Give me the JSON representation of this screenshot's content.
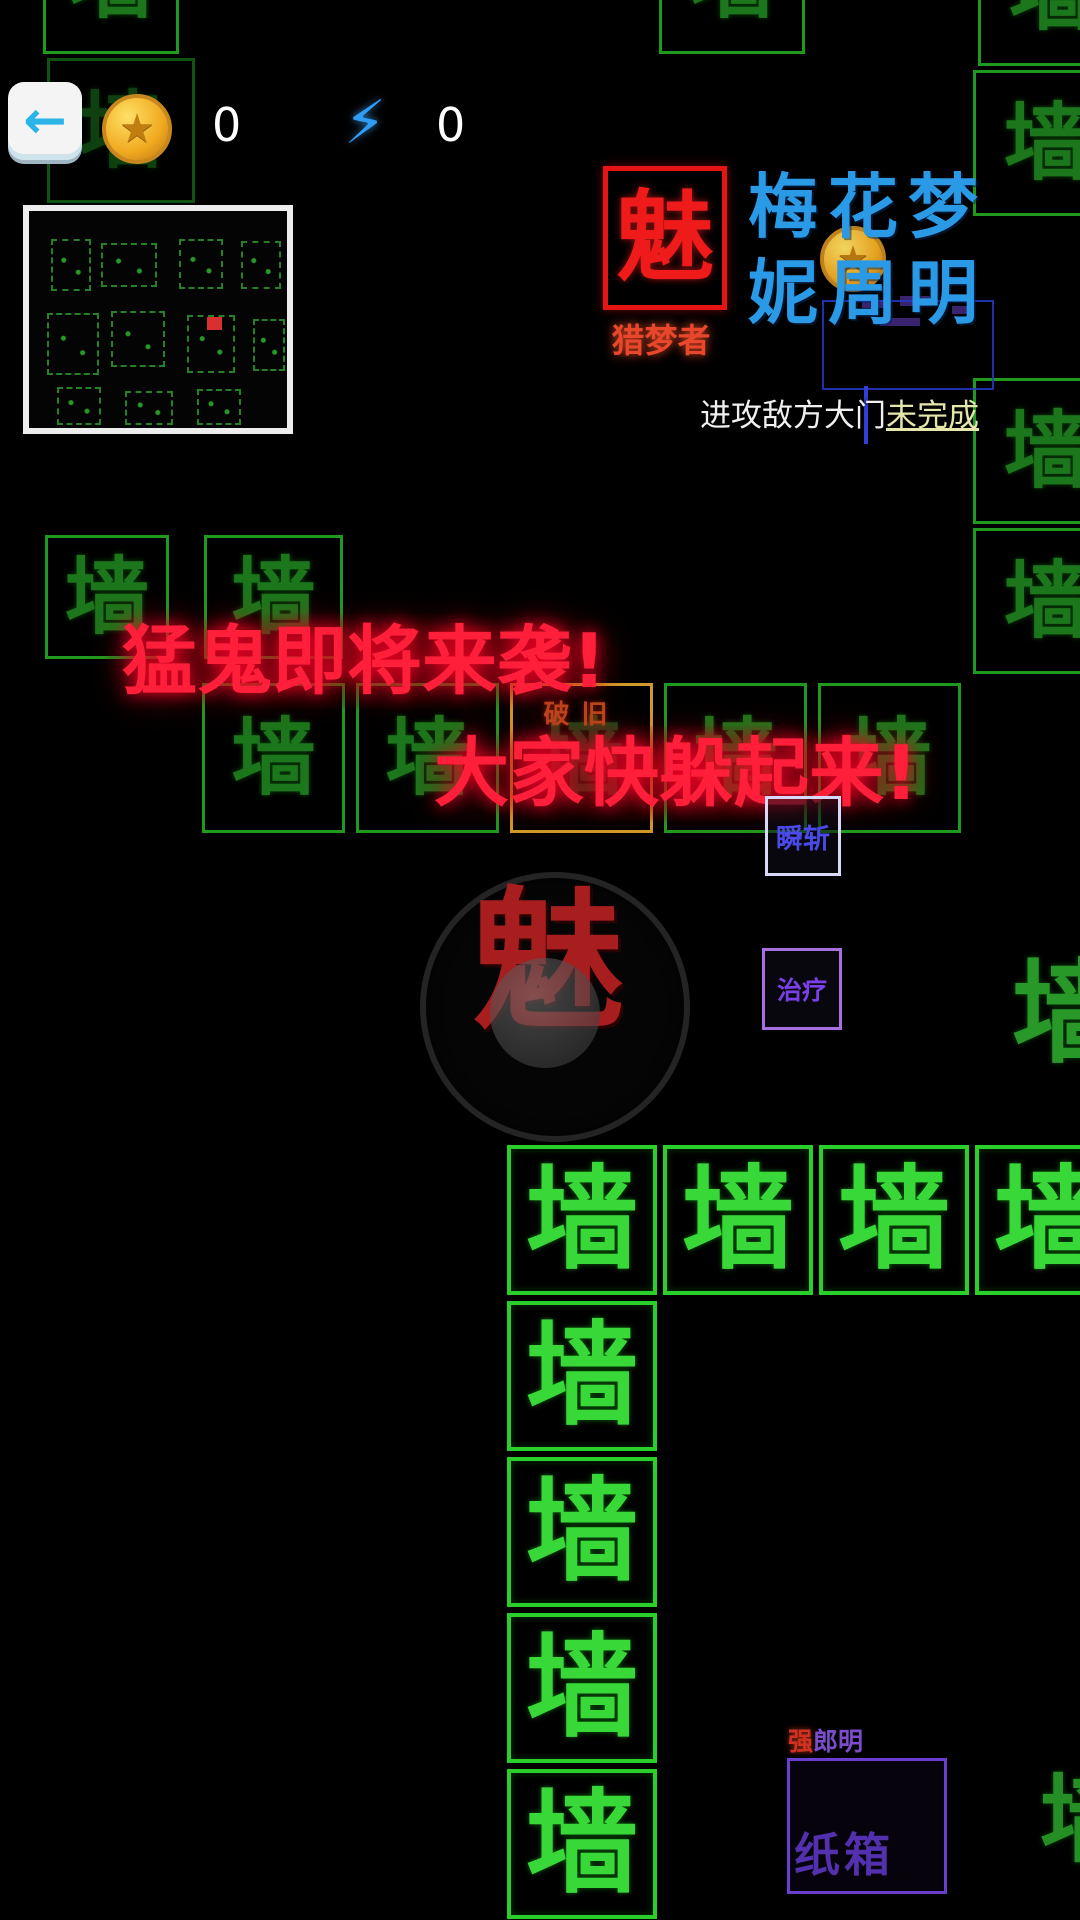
{
  "hud": {
    "back_icon": "←",
    "coin_star": "★",
    "coin_count": "0",
    "bolt_icon": "⚡",
    "energy_count": "0"
  },
  "logo": {
    "glyph": "魅",
    "subtitle": "猎梦者"
  },
  "player": {
    "name_line1": "梅花梦",
    "name_line2": "妮周明"
  },
  "quest": {
    "text": "进攻敌方大门",
    "status": "未完成"
  },
  "warnings": {
    "line1": "猛鬼即将来袭!",
    "line2": "大家快躲起来!"
  },
  "tiles": {
    "wall_glyph": "墙",
    "worn_label": "破旧"
  },
  "character": {
    "glyph": "魅"
  },
  "skills": {
    "skill1": "瞬斩",
    "skill2": "治疗"
  },
  "crate": {
    "tag_red": "强",
    "tag_purple": "郎明",
    "label": "纸箱"
  },
  "colors": {
    "wall_green": "#2bcf2b",
    "warning_red": "#ff1f3a",
    "logo_red": "#ef1a1a",
    "name_blue": "#2b9ae6",
    "worn_orange": "#d09a28",
    "crate_purple": "#6a3fd0",
    "status_yellow": "#e6e6ac"
  }
}
